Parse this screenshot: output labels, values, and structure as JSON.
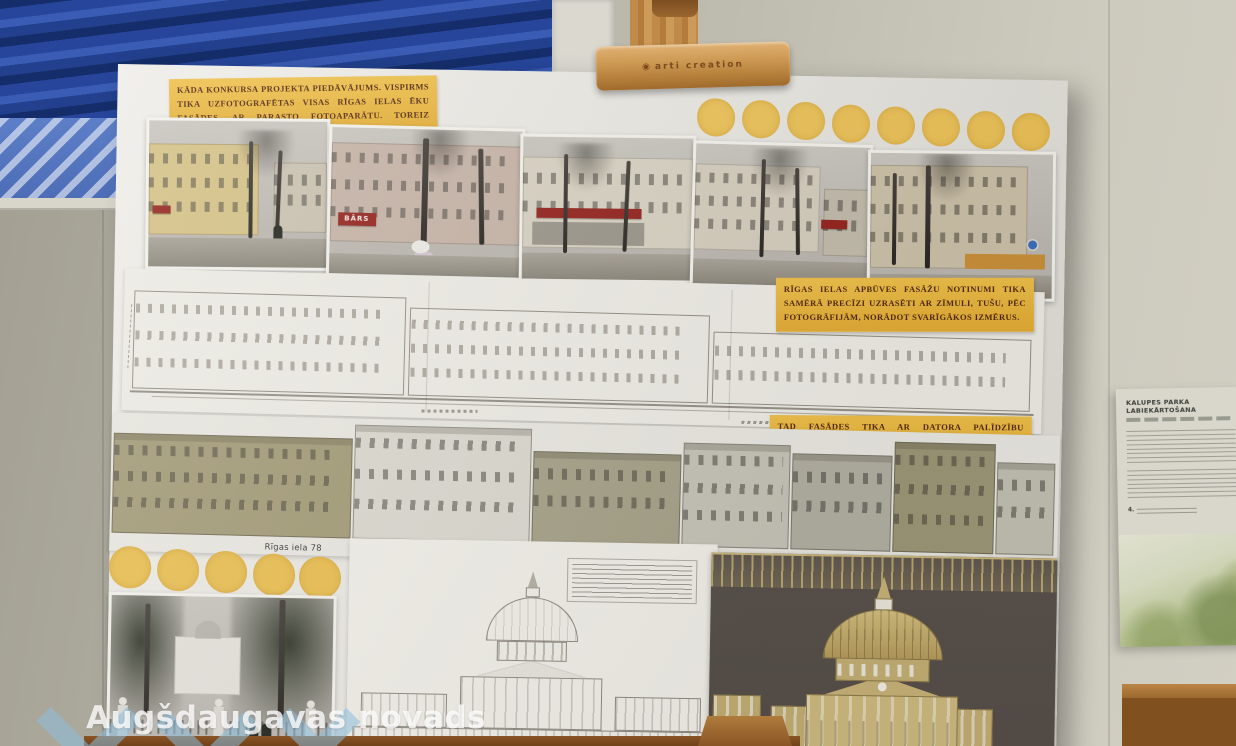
{
  "page": {
    "watermark": "Augšdaugavas novads"
  },
  "easel": {
    "logo": "arti creation",
    "logo_mark_icon": "◉"
  },
  "poster": {
    "notes": [
      "KĀDA KONKURSA PROJEKTA PIEDĀVĀJUMS. VISPIRMS TIKA UZFOTOGRAFĒTAS VISAS RĪGAS IELAS ĒKU FASĀDES, AR PARASTO FOTOAPARĀTU. TOREIZ DARBNĪCĀ NO FILMIŅĀM KOPĒJA BILDES.",
      "RĪGAS IELAS APBŪVES FASĀŽU NOTINUMI TIKA SAMĒRĀ PRECĪZI UZRASĒTI AR ZĪMULI, TUŠU, PĒC FOTOGRĀFIJĀM, NORĀDOT SVARĪGĀKOS IZMĒRUS.",
      "TAD FASĀDES TIKA AR DATORA PALĪDZĪBU IZSTRĀDĀTAS JAU CITĀ IZPILDĪJUMĀ."
    ],
    "addresses": [
      "Rīgas iela 78",
      "Rīgas iela 76",
      "Rīgas iela 74",
      "Rīgas iela 72",
      "Rīgas iela 70A",
      "Rīgas"
    ],
    "photo_signs": {
      "bars": "BĀRS"
    },
    "colors": {
      "note_yellow": "#e8b33c",
      "dot_yellow": "#ecc258",
      "easel_wood": "#c08b4a",
      "tapestry_blue": "#27469b",
      "render_gold": "#cdb97f",
      "render_background": "#59524c"
    }
  },
  "side_poster": {
    "title": "KALUPES PARKA LABIEKĀRTOŠANA",
    "item_marker": "4."
  }
}
